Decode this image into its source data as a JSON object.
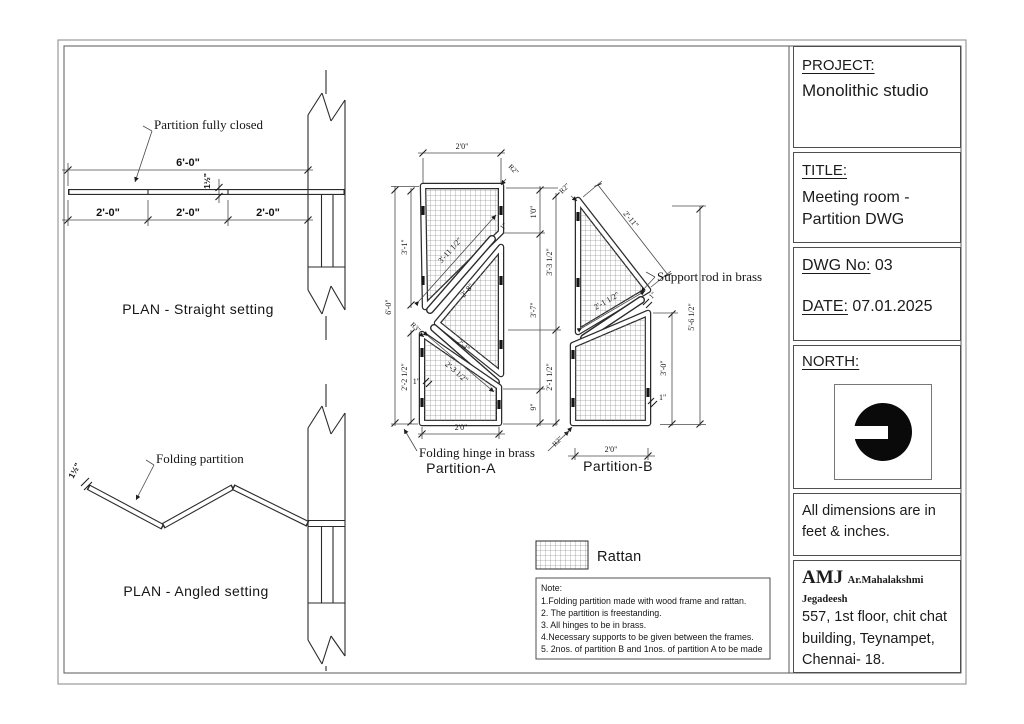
{
  "title_block": {
    "project_label": "PROJECT:",
    "project_name": "Monolithic studio",
    "title_label": "TITLE:",
    "title_line1": "Meeting room -",
    "title_line2": "Partition DWG",
    "dwg_no_label": "DWG No:",
    "dwg_no_value": "03",
    "date_label": "DATE:",
    "date_value": "07.01.2025",
    "north_label": "NORTH:",
    "units_note_line1": "All dimensions are in",
    "units_note_line2": "feet & inches.",
    "firm": "AMJ",
    "architect": "Ar.Mahalakshmi Jegadeesh",
    "address_line1": "557, 1st floor, chit chat",
    "address_line2": "building, Teynampet,",
    "address_line3": "Chennai- 18."
  },
  "plan_straight": {
    "caption": "PLAN - Straight setting",
    "callout": "Partition fully closed",
    "dim_total": "6'-0\"",
    "dim_seg": "2'-0\"",
    "dim_thickness": "1½\""
  },
  "plan_angled": {
    "caption": "PLAN - Angled setting",
    "callout": "Folding partition",
    "dim_thickness": "1½\""
  },
  "partition_a": {
    "caption": "Partition-A",
    "hinge_callout": "Folding hinge in brass",
    "dim_width": "2'0\"",
    "dim_height_total": "6'-0\"",
    "dim_panel1_height": "3'-1\"",
    "dim_panel3_height": "2'-2 1/2\"",
    "dim_right_top": "1'0\"",
    "dim_right_mid": "3'-7\"",
    "dim_right_bottom": "9\"",
    "dim_right_upper": "3'-3 1/2\"",
    "dim_right_lower": "2'-1 1/2\"",
    "dim_diag_panel1": "3'-11 1/2\"",
    "dim_diag_panel2": "2'-8\"",
    "dim_diag_rod": "2'-4\"",
    "dim_diag_panel3": "2'-3 1/2\"",
    "radius_top": "R2\"",
    "radius_mid": "R3\"",
    "thickness_left": "1\"",
    "thickness_top": "1\""
  },
  "partition_b": {
    "caption": "Partition-B",
    "rod_callout": "Support rod in brass",
    "dim_hypotenuse": "2'-11\"",
    "dim_bottom_edge": "2'-1 1/2\"",
    "dim_height_total": "5'-6 1/2\"",
    "dim_lower_height": "3'-0\"",
    "dim_width_bottom": "2'0\"",
    "radius_top": "R2\"",
    "radius_bottom": "R2\"",
    "thickness_rod": "1\"",
    "thickness_panel": "1\""
  },
  "legend": {
    "rattan_label": "Rattan"
  },
  "notes": {
    "heading": "Note:",
    "items": [
      "1.Folding partition made with wood frame and rattan.",
      "2. The partition is freestanding.",
      "3. All hinges to be in brass.",
      "4.Necessary supports to be given between the frames.",
      "5. 2nos. of partition B and 1nos. of partition A to be made"
    ]
  }
}
